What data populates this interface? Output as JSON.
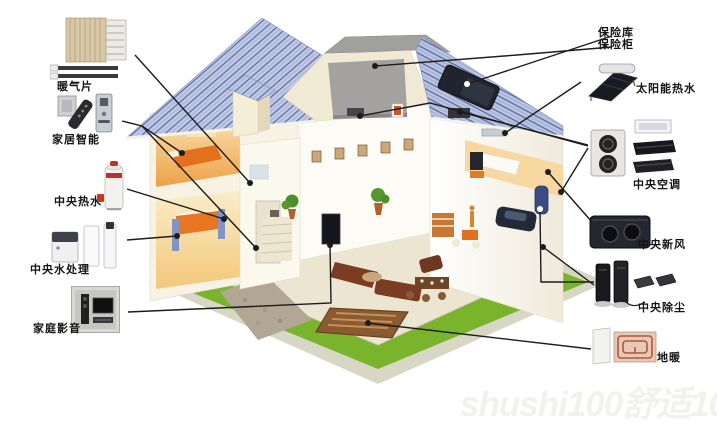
{
  "diagram_title": "",
  "watermark": {
    "text": "shushi100舒适100"
  },
  "annotations": {
    "left": [
      {
        "id": "radiator",
        "label": "暖气片",
        "icons": [
          "radiator-panel-icon",
          "towel-radiator-icon",
          "heating-pipe-icon",
          "heating-pipe-icon"
        ]
      },
      {
        "id": "smart-home",
        "label": "家居智能",
        "icons": [
          "wall-switch-icon",
          "remote-control-icon",
          "door-lock-icon"
        ]
      },
      {
        "id": "central-hot-water",
        "label": "中央热水",
        "icons": [
          "hot-water-tank-icon"
        ]
      },
      {
        "id": "central-water-treatment",
        "label": "中央水处理",
        "icons": [
          "water-softener-icon",
          "filter-column-icon",
          "filter-column-icon"
        ]
      },
      {
        "id": "home-av",
        "label": "家庭影音",
        "icons": [
          "speaker-icon",
          "tv-icon"
        ]
      }
    ],
    "right": [
      {
        "id": "safe",
        "label_line1": "保险库",
        "label_line2": "保险柜",
        "icons": [
          "roof-safe-icon"
        ]
      },
      {
        "id": "solar-hot-water",
        "label": "太阳能热水",
        "icons": [
          "solar-collector-icon"
        ]
      },
      {
        "id": "central-ac",
        "label": "中央空调",
        "icons": [
          "ac-outdoor-unit-icon",
          "ceiling-cassette-icon",
          "duct-unit-icon",
          "duct-unit-icon"
        ]
      },
      {
        "id": "central-fresh-air",
        "label": "中央新风",
        "icons": [
          "ventilation-unit-icon"
        ]
      },
      {
        "id": "central-vacuum",
        "label": "中央除尘",
        "icons": [
          "vacuum-tower-icon",
          "vacuum-tower-icon",
          "dust-pan-icon",
          "dust-pan-icon",
          "curved-arrow-icon"
        ]
      },
      {
        "id": "floor-heating",
        "label": "地暖",
        "icons": [
          "insulation-board-icon",
          "heating-coil-icon"
        ]
      }
    ]
  },
  "colors": {
    "leader_line": "#1c1c1c",
    "roof_tile": "#bfc9e4",
    "roof_tile_line": "#5d6aa4",
    "wall_cream": "#f7f2e4",
    "interior_warm": "#eda045",
    "lawn_green": "#79b42c",
    "path_gray": "#b2a695",
    "accent_orange": "#e8701e",
    "label_text": "#141414",
    "watermark": "#f1f1ee"
  }
}
